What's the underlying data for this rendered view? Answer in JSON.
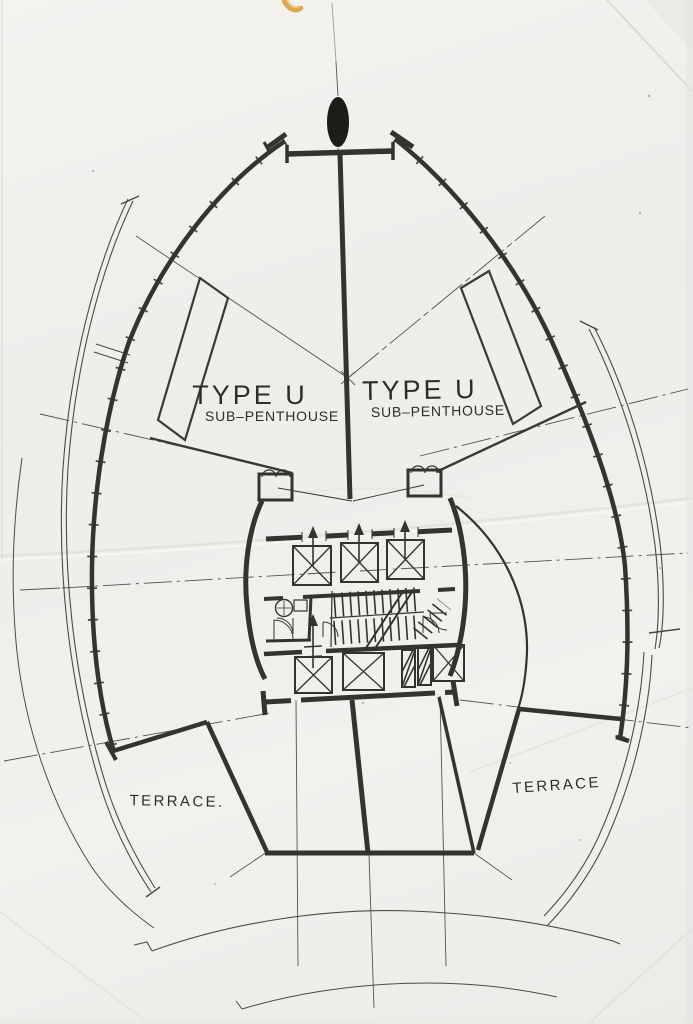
{
  "drawing": {
    "kind": "scanned floor plan",
    "unit_left": {
      "title": "TYPE U",
      "subtitle": "SUB–PENTHOUSE"
    },
    "unit_right": {
      "title": "TYPE U",
      "subtitle": "SUB–PENTHOUSE"
    },
    "terrace_left": {
      "label": "TERRACE."
    },
    "terrace_right": {
      "label": "TERRACE"
    },
    "colors": {
      "paper": "#f1f0ed",
      "ink": "#34332f",
      "ink_thin": "#55534d",
      "smudge": "#d89b33"
    }
  }
}
